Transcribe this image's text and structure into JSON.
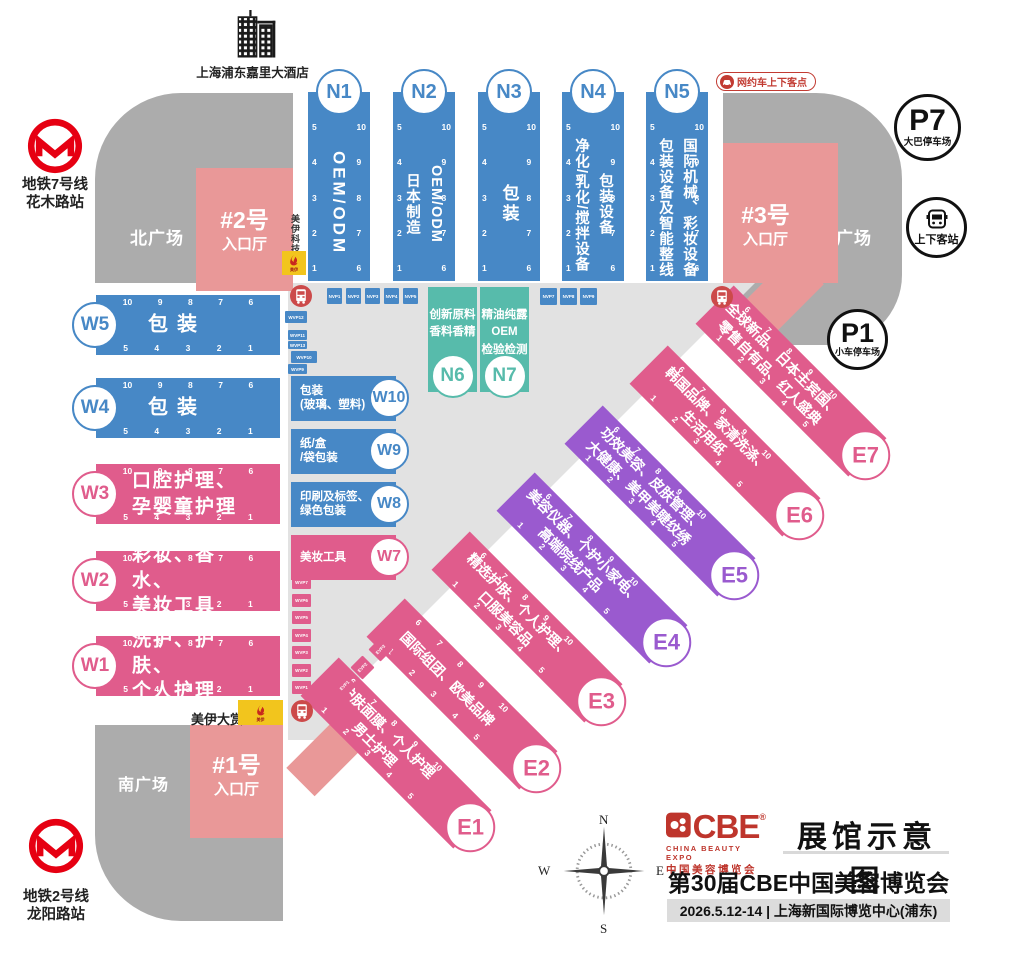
{
  "colors": {
    "blue": "#4788C6",
    "teal": "#57BBAB",
    "pink": "#E05C8C",
    "purple": "#9A5ACF",
    "salmon": "#E99898",
    "gray_dark": "#ACACAC",
    "gray_light": "#E2E2E2",
    "yellow": "#F2C51D",
    "bus_red": "#CC4A4A",
    "metro_red": "#E60012",
    "badge_red": "#C23B32",
    "cbe_red": "#BE352C"
  },
  "stations": {
    "metro7": {
      "lines": [
        "地铁7号线",
        "花木路站"
      ]
    },
    "metro2": {
      "lines": [
        "地铁2号线",
        "龙阳路站"
      ]
    },
    "hotel": {
      "label": "上海浦东嘉里大酒店"
    },
    "rideshare_badge": {
      "label": "网约车上下客点"
    },
    "dropoff": {
      "label": "上下客站"
    }
  },
  "parking": {
    "p7": {
      "id": "P7",
      "label": "大巴停车场"
    },
    "p1": {
      "id": "P1",
      "label": "小车停车场"
    }
  },
  "plazas": {
    "north": "北广场",
    "south": "南广场",
    "east": "东广场"
  },
  "entrances": {
    "e2": {
      "id": "#2号",
      "label": "入口厅"
    },
    "e3": {
      "id": "#3号",
      "label": "入口厅"
    },
    "e1": {
      "id": "#1号",
      "label": "入口厅"
    }
  },
  "sponsor": {
    "tech": "美伊科技",
    "award": "美伊大赏",
    "brand": "美伊"
  },
  "halls": {
    "north": [
      {
        "id": "N1",
        "cols": [
          "OEM/ODM"
        ],
        "color": "blue",
        "cx": 339
      },
      {
        "id": "N2",
        "cols": [
          "OEM/ODM",
          "日本制造"
        ],
        "color": "blue",
        "cx": 424
      },
      {
        "id": "N3",
        "cols": [
          "包装"
        ],
        "color": "blue",
        "cx": 509
      },
      {
        "id": "N4",
        "cols": [
          "包装设备",
          "净化/乳化/搅拌设备"
        ],
        "color": "blue",
        "cx": 593
      },
      {
        "id": "N5",
        "cols": [
          "国际机械、彩妆设备",
          "包装设备及智能整线"
        ],
        "color": "blue",
        "cx": 677
      }
    ],
    "north_annex": [
      {
        "id": "N6",
        "lines": [
          "创新原料",
          "香料香精"
        ],
        "color": "teal",
        "x": 428
      },
      {
        "id": "N7",
        "lines": [
          "精油纯露",
          "OEM",
          "检验检测"
        ],
        "color": "teal",
        "x": 480
      }
    ],
    "west": [
      {
        "id": "W5",
        "lines": [
          "包装"
        ],
        "color": "blue",
        "y": 295
      },
      {
        "id": "W4",
        "lines": [
          "包装"
        ],
        "color": "blue",
        "y": 378
      },
      {
        "id": "W3",
        "lines": [
          "口腔护理、",
          "孕婴童护理"
        ],
        "color": "pink",
        "y": 464
      },
      {
        "id": "W2",
        "lines": [
          "彩妆、香水、",
          "美妆工具"
        ],
        "color": "pink",
        "y": 551
      },
      {
        "id": "W1",
        "lines": [
          "洗护、护肤、",
          "个人护理"
        ],
        "color": "pink",
        "y": 636
      }
    ],
    "west_annex": [
      {
        "id": "W10",
        "lines": [
          "包装",
          "(玻璃、塑料)"
        ],
        "color": "blue",
        "y": 376
      },
      {
        "id": "W9",
        "lines": [
          "纸/盒",
          "/袋包装"
        ],
        "color": "blue",
        "y": 429
      },
      {
        "id": "W8",
        "lines": [
          "印刷及标签、",
          "绿色包装"
        ],
        "color": "blue",
        "y": 482
      },
      {
        "id": "W7",
        "lines": [
          "美妆工具"
        ],
        "color": "pink",
        "y": 535
      }
    ],
    "east": [
      {
        "id": "E1",
        "lines": [
          "护肤面膜、个人护理",
          "男士护理"
        ],
        "color": "pink",
        "cx": 472,
        "cy": 829
      },
      {
        "id": "E2",
        "lines": [
          "国际组团、欧美品牌"
        ],
        "color": "pink",
        "cx": 538,
        "cy": 770
      },
      {
        "id": "E3",
        "lines": [
          "精选护肤、个人护理、",
          "口服美容品"
        ],
        "color": "pink",
        "cx": 603,
        "cy": 703
      },
      {
        "id": "E4",
        "lines": [
          "美容仪器、个护小家电、",
          "高端院线产品"
        ],
        "color": "purple",
        "cx": 668,
        "cy": 644
      },
      {
        "id": "E5",
        "lines": [
          "功效美容、皮肤管理、",
          "大健康、美甲美睫纹绣"
        ],
        "color": "purple",
        "cx": 736,
        "cy": 577
      },
      {
        "id": "E6",
        "lines": [
          "韩国品牌、家清洗涤、",
          "生活用纸"
        ],
        "color": "pink",
        "cx": 801,
        "cy": 517
      },
      {
        "id": "E7",
        "lines": [
          "全球新品、日本主宾国、",
          "零售自有品、红人盛典"
        ],
        "color": "pink",
        "cx": 867,
        "cy": 457
      }
    ],
    "numbers": {
      "n_left": [
        "5",
        "4",
        "3",
        "2",
        "1"
      ],
      "n_right": [
        "10",
        "9",
        "8",
        "7",
        "6"
      ],
      "w_top": [
        "10",
        "9",
        "8",
        "7",
        "6"
      ],
      "w_bottom": [
        "5",
        "4",
        "3",
        "2",
        "1"
      ],
      "e_top": [
        "6",
        "7",
        "8",
        "9",
        "10"
      ],
      "e_bottom": [
        "1",
        "2",
        "3",
        "4",
        "5"
      ]
    }
  },
  "minis": {
    "nvp_left": [
      "NVP1",
      "NVP2",
      "NVP3",
      "NVP4",
      "NVP5"
    ],
    "nvp_right": [
      "NVP7",
      "NVP8",
      "NVP9"
    ],
    "wvp_upper": [
      "WVP12",
      "WVP11",
      "WVP13",
      "WVP10",
      "WVP9"
    ],
    "wvp_lower": [
      "WVP7",
      "WVP6",
      "WVP5",
      "WVP4",
      "WVP3",
      "WVP2",
      "WVP1"
    ],
    "evp": [
      "EVP1",
      "EVP2",
      "EVP3"
    ]
  },
  "transit": {
    "bus_stops": [
      [
        301,
        296
      ],
      [
        722,
        297
      ],
      [
        302,
        711
      ]
    ]
  },
  "compass": {
    "n": "N",
    "e": "E",
    "s": "S",
    "w": "W"
  },
  "footer": {
    "logo_text": "CBE",
    "logo_reg": "®",
    "logo_sub1": "CHINA BEAUTY EXPO",
    "logo_sub2": "中国美容博览会",
    "map_title": "展馆示意图",
    "expo_title": "第30届CBE中国美容博览会",
    "date_venue": "2026.5.12-14 | 上海新国际博览中心(浦东)"
  }
}
